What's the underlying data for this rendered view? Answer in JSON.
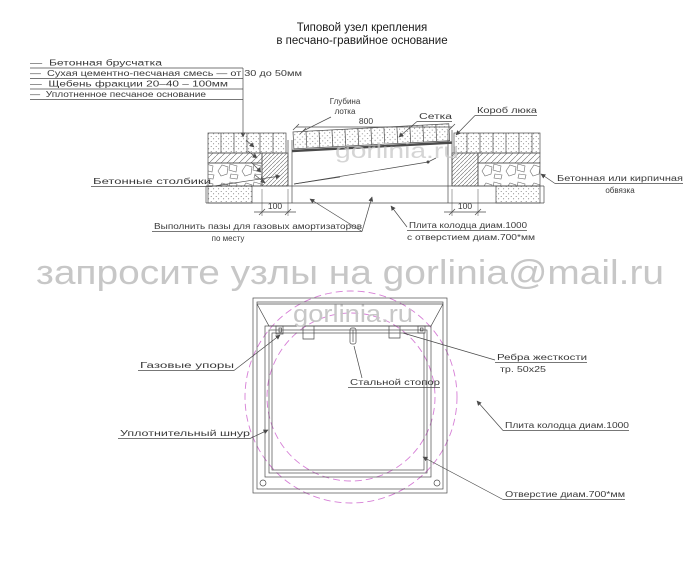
{
  "title": {
    "line1": "Типовой узел крепления",
    "line2": "в песчано-гравийное основание"
  },
  "legend": {
    "items": [
      "—  Бетонная брусчатка",
      "—  Сухая цементно-песчаная смесь — от 30 до 50мм",
      "—  Щебень фракции 20–40 – 100мм",
      "—  Уплотненное песчаное основание"
    ]
  },
  "section": {
    "dim_width": "800",
    "dim_post_left": "100",
    "dim_post_right": "100",
    "labels": {
      "depth_line1": "Глубина",
      "depth_line2": "лотка",
      "mesh": "Сетка",
      "box": "Короб люка",
      "posts": "Бетонные столбики",
      "note_line1": "Выполнить пазы для газовых амортизаторов",
      "note_line2": "по месту",
      "slab_line1": "Плита колодца диам.1000",
      "slab_line2": "с отверстием диам.700*мм",
      "edging_line1": "Бетонная или кирпичная",
      "edging_line2": "обвязка"
    }
  },
  "plan": {
    "labels": {
      "gas_struts": "Газовые упоры",
      "steel_stopper": "Стальной стопор",
      "ribs_line1": "Ребра жесткости",
      "ribs_line2": "тр. 50х25",
      "seal_cord": "Уплотнительный шнур",
      "slab": "Плита колодца диам.1000",
      "hole": "Отверстие диам.700*мм"
    }
  },
  "watermarks": {
    "request": "запросите узлы на gorlinia@mail.ru",
    "brand_section": "gorlinia.ru",
    "brand_plan": "gorlinia.ru"
  },
  "colors": {
    "line": "#4a4a4a",
    "text": "#3a3a3a",
    "accent": "#d67fd6",
    "watermark": "#c7c7c7"
  }
}
